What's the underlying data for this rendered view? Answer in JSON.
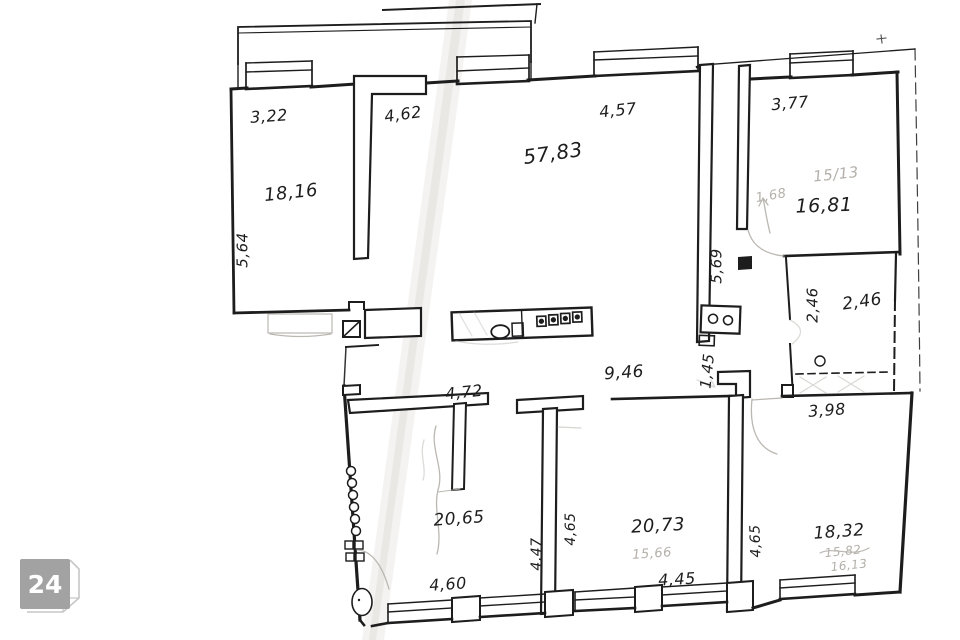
{
  "watermark": {
    "label": "24"
  },
  "plan": {
    "room_areas": {
      "top_left": "18,16",
      "living": "57,83",
      "top_right": "16,81",
      "storage": "2,46",
      "bottom_left": "20,65",
      "bottom_middle": "20,73",
      "bottom_right": "18,32"
    },
    "dimensions": {
      "d3_22": "3,22",
      "d4_62": "4,62",
      "d4_57": "4,57",
      "d3_77": "3,77",
      "d5_64": "5,64",
      "d5_69": "5,69",
      "d2_46": "2,46",
      "d9_46": "9,46",
      "d1_45": "1,45",
      "d3_98": "3,98",
      "d4_72": "4,72",
      "d4_60": "4,60",
      "d4_47": "4,47",
      "d4_65_left": "4,65",
      "d4_45": "4,45",
      "d4_65_right": "4,65"
    },
    "pencil_notes": {
      "n15_13": "15/13",
      "n1_68": "1,68",
      "n15_66": "15,66",
      "n15_82": "15,82",
      "n16_13": "16,13"
    }
  },
  "colors": {
    "ink": "#1d1d1d",
    "pencil": "#b4b0aa",
    "paper": "#ffffff",
    "crease": "#e7e5e1",
    "watermark_fill": "#a2a2a2",
    "watermark_outline": "#c7c7c7"
  }
}
